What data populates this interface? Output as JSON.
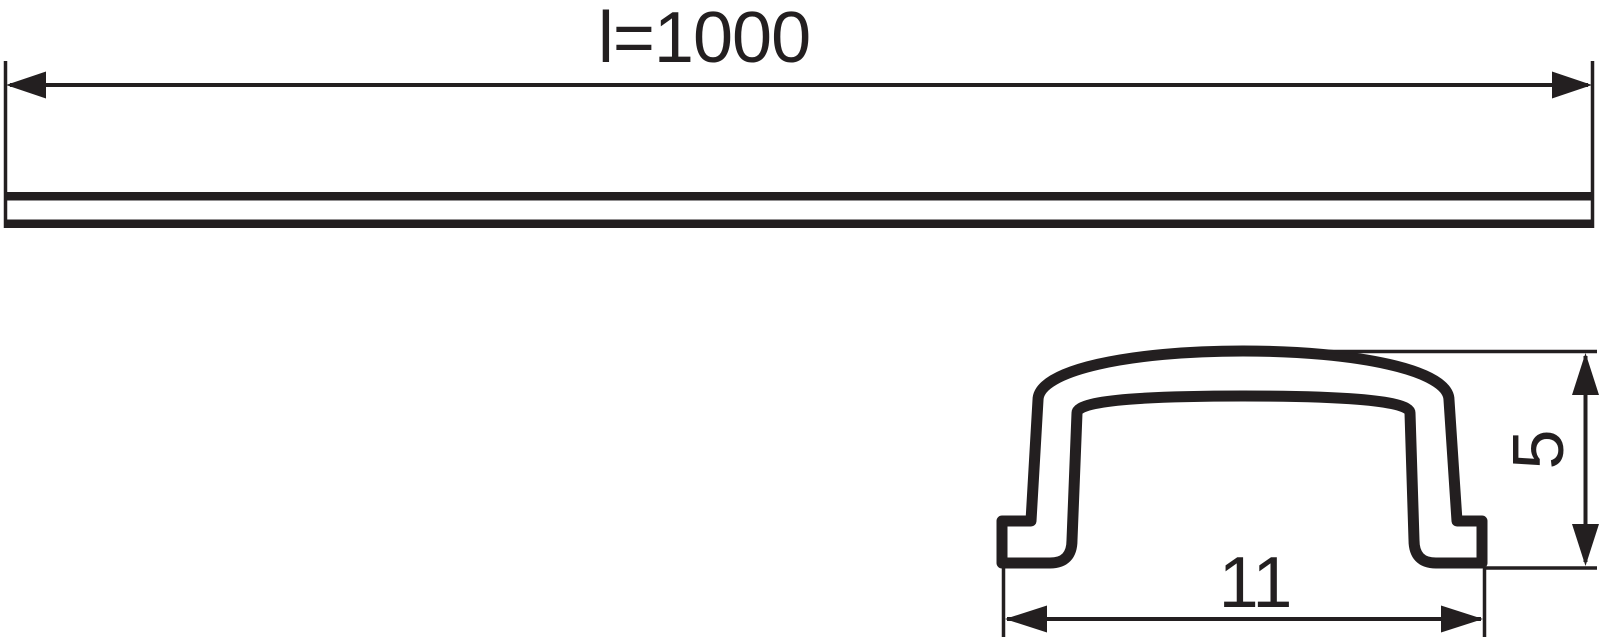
{
  "colors": {
    "ink": "#231f20",
    "paper": "#ffffff"
  },
  "drawing": {
    "kind": "technical-dimension-drawing",
    "front_view": {
      "length_dimension_label": "l=1000",
      "length_value": 1000
    },
    "section_view": {
      "width_dimension_label": "11",
      "width_value": 11,
      "height_dimension_label": "5",
      "height_value": 5
    }
  }
}
